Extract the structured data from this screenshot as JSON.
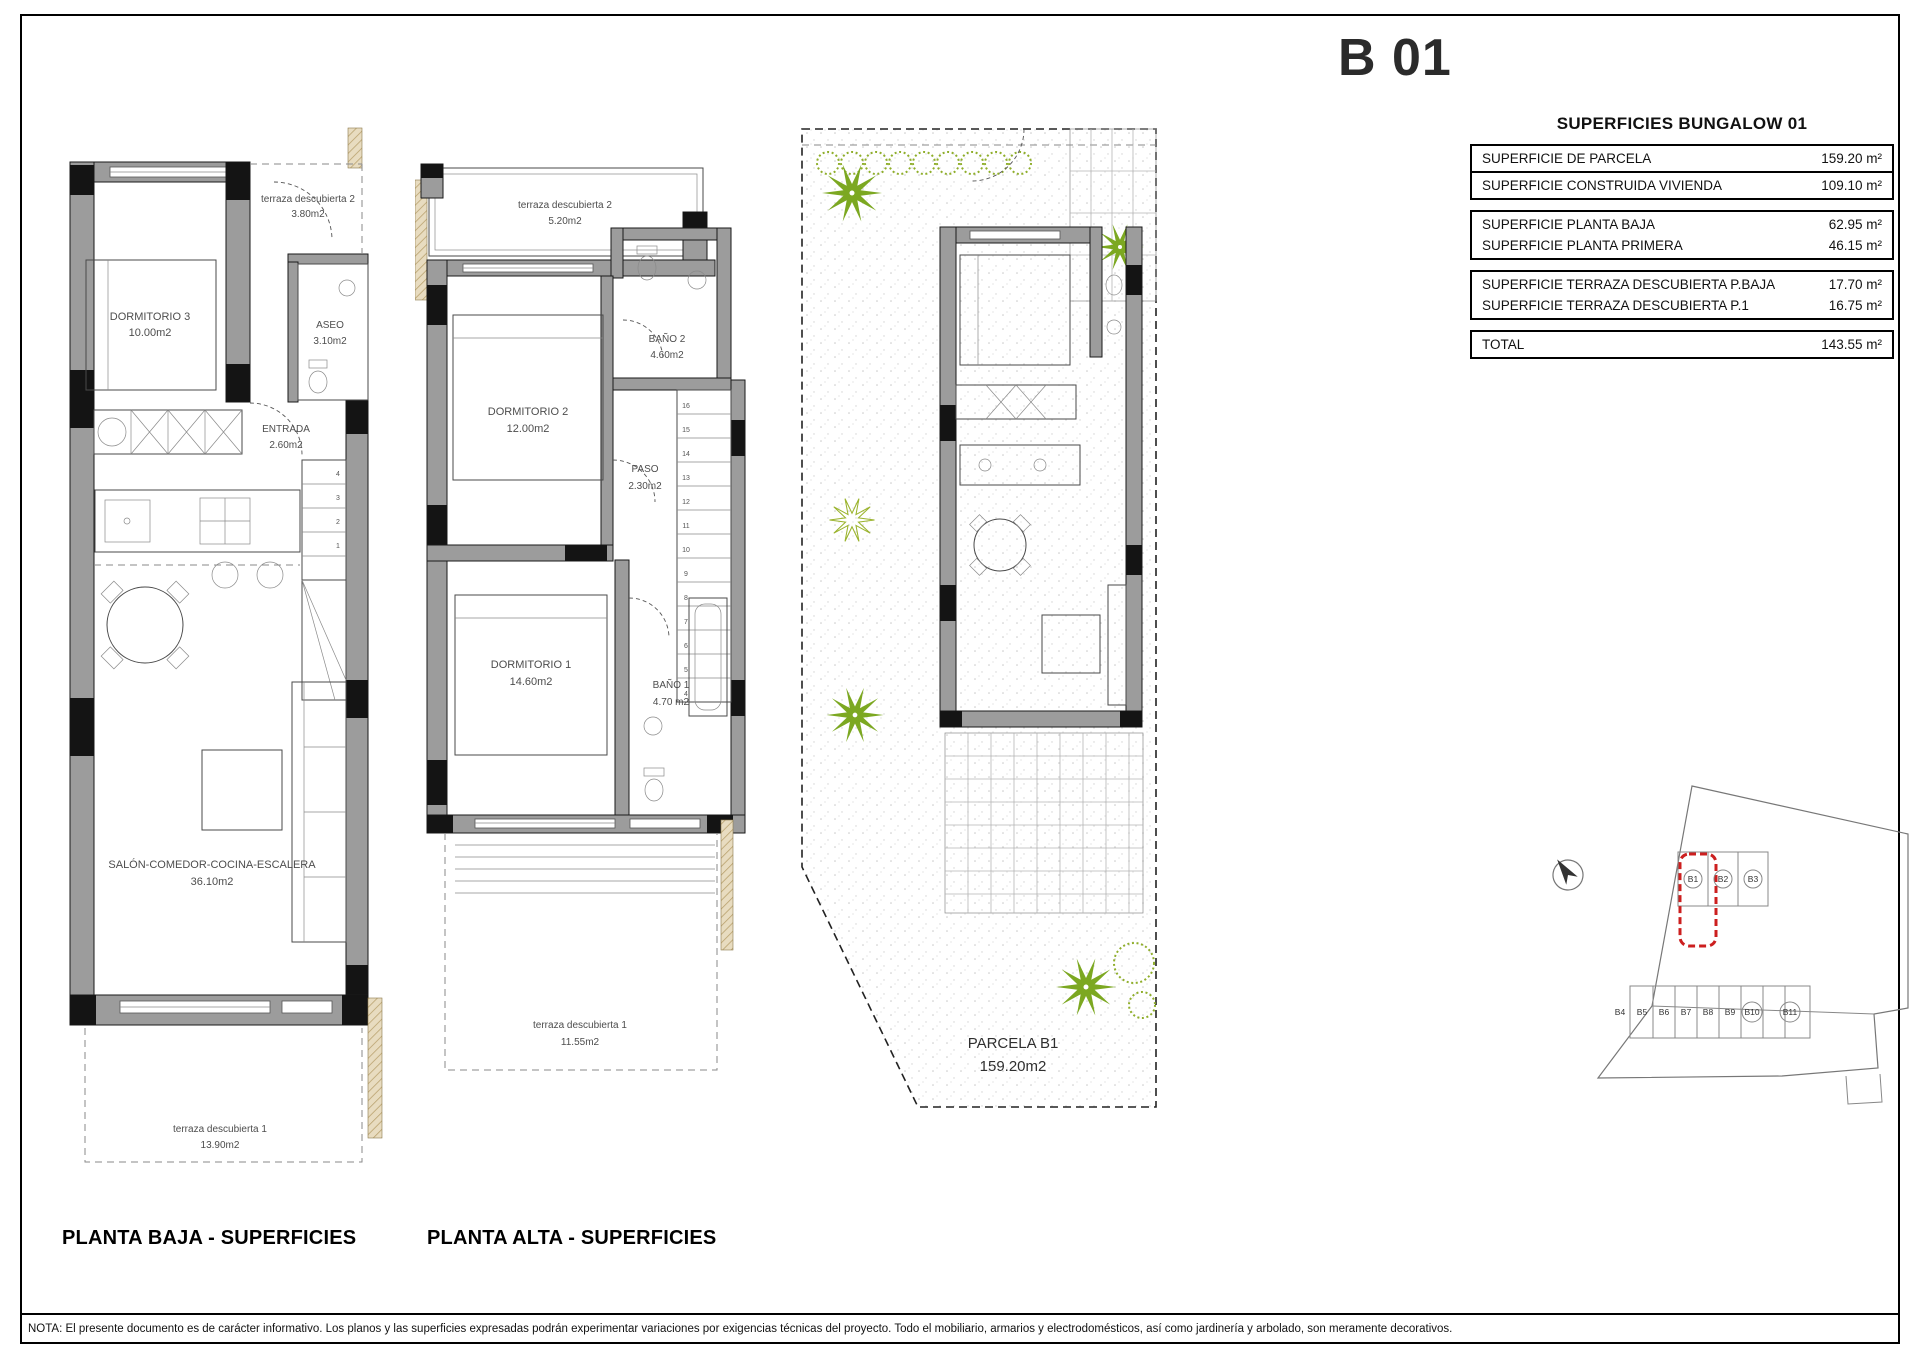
{
  "page": {
    "code": "B 01",
    "note": "NOTA: El presente documento es de carácter informativo. Los planos y las superficies expresadas podrán experimentar variaciones por exigencias técnicas del proyecto. Todo el mobiliario, armarios y electrodomésticos, así como jardinería y arbolado, son meramente decorativos."
  },
  "summary": {
    "title": "SUPERFICIES BUNGALOW 01",
    "rows": [
      {
        "label": "SUPERFICIE DE PARCELA",
        "value": "159.20 m²"
      },
      {
        "label": "SUPERFICIE CONSTRUIDA VIVIENDA",
        "value": "109.10 m²"
      },
      {
        "label": "SUPERFICIE PLANTA BAJA",
        "value": "62.95 m²"
      },
      {
        "label": "SUPERFICIE PLANTA PRIMERA",
        "value": "46.15 m²"
      },
      {
        "label": "SUPERFICIE TERRAZA DESCUBIERTA P.BAJA",
        "value": "17.70 m²"
      },
      {
        "label": "SUPERFICIE TERRAZA DESCUBIERTA P.1",
        "value": "16.75 m²"
      },
      {
        "label": "TOTAL",
        "value": "143.55 m²"
      }
    ]
  },
  "planta_baja": {
    "title": "PLANTA BAJA - SUPERFICIES",
    "rooms": {
      "terraza2": {
        "name": "terraza descubierta 2",
        "area": "3.80m2"
      },
      "dormitorio3": {
        "name": "DORMITORIO 3",
        "area": "10.00m2"
      },
      "aseo": {
        "name": "ASEO",
        "area": "3.10m2"
      },
      "entrada": {
        "name": "ENTRADA",
        "area": "2.60m2"
      },
      "salon": {
        "name": "SALÓN-COMEDOR-COCINA-ESCALERA",
        "area": "36.10m2"
      },
      "terraza1": {
        "name": "terraza descubierta 1",
        "area": "13.90m2"
      }
    },
    "stair_numbers": [
      "4",
      "3",
      "2",
      "1"
    ]
  },
  "planta_alta": {
    "title": "PLANTA ALTA - SUPERFICIES",
    "rooms": {
      "terraza2": {
        "name": "terraza descubierta 2",
        "area": "5.20m2"
      },
      "dormitorio2": {
        "name": "DORMITORIO 2",
        "area": "12.00m2"
      },
      "bano2": {
        "name": "BAÑO 2",
        "area": "4.60m2"
      },
      "paso": {
        "name": "PASO",
        "area": "2.30m2"
      },
      "dormitorio1": {
        "name": "DORMITORIO 1",
        "area": "14.60m2"
      },
      "bano1": {
        "name": "BAÑO 1",
        "area": "4.70 m2"
      },
      "terraza1": {
        "name": "terraza descubierta 1",
        "area": "11.55m2"
      }
    },
    "stair_numbers": [
      "16",
      "15",
      "14",
      "13",
      "12",
      "11",
      "10",
      "9",
      "8",
      "7",
      "6",
      "5",
      "4"
    ]
  },
  "site_plan": {
    "parcel_name": "PARCELA B1",
    "parcel_area": "159.20m2"
  },
  "location_map": {
    "plots": [
      "B1",
      "B2",
      "B3",
      "B4",
      "B5",
      "B6",
      "B7",
      "B8",
      "B9",
      "B10",
      "B11"
    ],
    "highlight_color": "#cc1f1f"
  },
  "colors": {
    "wall_gray": "#9c9c9c",
    "plant_green": "#7CA821",
    "hatch_tan": "#e8dcc0"
  }
}
